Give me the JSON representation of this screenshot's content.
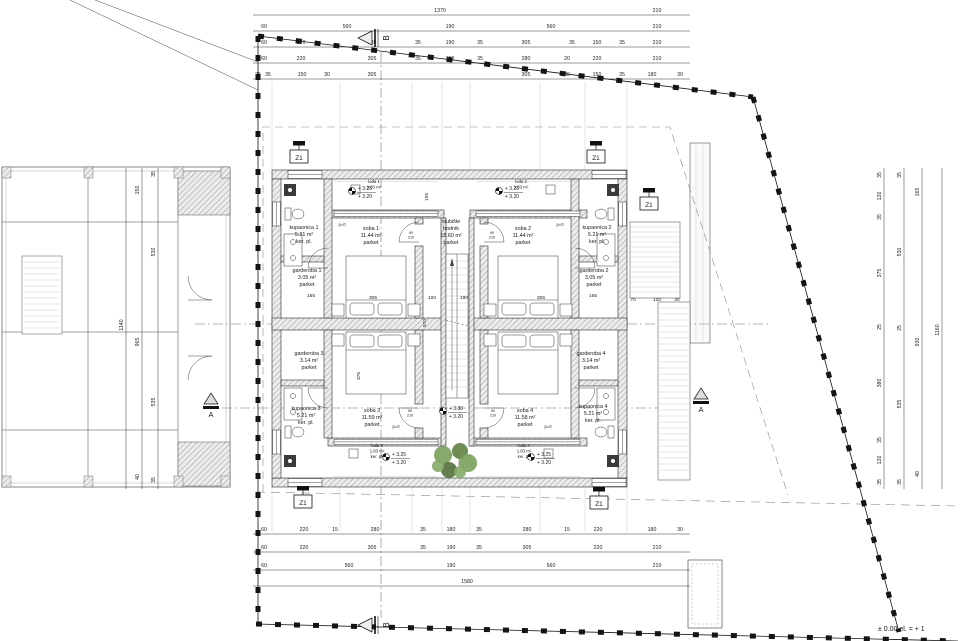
{
  "colors": {
    "plant_green": "#6b8f52",
    "plant_dark": "#53703c",
    "wall_hatch": "#ececec",
    "boundary": "#141414"
  },
  "rooms": [
    {
      "x": 304,
      "y": 229,
      "lines": [
        "kupaonica 1",
        "5.21 m²",
        "ker. pl."
      ]
    },
    {
      "x": 307,
      "y": 272,
      "lines": [
        "garderoba 1",
        "3.05 m²",
        "parket"
      ]
    },
    {
      "x": 371,
      "y": 230,
      "lines": [
        "soba 1",
        "11.44 m²",
        "parket"
      ]
    },
    {
      "x": 451,
      "y": 223,
      "lines": [
        "stubište",
        "hodnik",
        "15.60 m²",
        "parket"
      ]
    },
    {
      "x": 523,
      "y": 230,
      "lines": [
        "soba 2",
        "11.44 m²",
        "parket"
      ]
    },
    {
      "x": 597,
      "y": 229,
      "lines": [
        "kupaonica 2",
        "5.21 m²",
        "ker. pl."
      ]
    },
    {
      "x": 594,
      "y": 272,
      "lines": [
        "garderoba 2",
        "3.05 m²",
        "parket"
      ]
    },
    {
      "x": 309,
      "y": 355,
      "lines": [
        "garderoba 3",
        "3.14 m²",
        "parket"
      ]
    },
    {
      "x": 306,
      "y": 410,
      "lines": [
        "kupaonica 3",
        "5.21 m²",
        "ker. pl."
      ]
    },
    {
      "x": 372,
      "y": 412,
      "lines": [
        "soba 3",
        "11.59 m²",
        "parket"
      ]
    },
    {
      "x": 525,
      "y": 412,
      "lines": [
        "soba 4",
        "11.58 m²",
        "parket"
      ]
    },
    {
      "x": 591,
      "y": 355,
      "lines": [
        "garderoba 4",
        "3.14 m²",
        "parket"
      ]
    },
    {
      "x": 593,
      "y": 408,
      "lines": [
        "kupaonica 4",
        "5.21 m²",
        "ker. pl."
      ]
    }
  ],
  "loggias": [
    {
      "x": 374,
      "y": 183,
      "lines": [
        "lođa 1",
        "1.83 m²"
      ]
    },
    {
      "x": 521,
      "y": 183,
      "lines": [
        "lođa 2",
        "1.83 m²"
      ]
    },
    {
      "x": 377,
      "y": 447,
      "lines": [
        "lođa 3",
        "1.83 m²",
        "ker. pl."
      ]
    },
    {
      "x": 524,
      "y": 447,
      "lines": [
        "lođa 4",
        "1.83 m²",
        "ker. pl."
      ]
    }
  ],
  "elevations": [
    {
      "x": 352,
      "y": 191,
      "lines": [
        "+ 3.25",
        "+ 3.20"
      ]
    },
    {
      "x": 499,
      "y": 191,
      "lines": [
        "+ 3.25",
        "+ 3.20"
      ]
    },
    {
      "x": 443,
      "y": 411,
      "lines": [
        "+ 3.30",
        "+ 3.20"
      ]
    },
    {
      "x": 386,
      "y": 457,
      "lines": [
        "+ 3.25",
        "+ 3.20"
      ]
    },
    {
      "x": 531,
      "y": 457,
      "lines": [
        "+ 3.25",
        "+ 3.20"
      ]
    }
  ],
  "detail_markers": [
    {
      "label": "Z1",
      "x": 299,
      "y": 157
    },
    {
      "label": "Z1",
      "x": 596,
      "y": 157
    },
    {
      "label": "Z1",
      "x": 649,
      "y": 204
    },
    {
      "label": "Z1",
      "x": 303,
      "y": 502
    },
    {
      "label": "Z1",
      "x": 599,
      "y": 503
    }
  ],
  "section_markers": [
    {
      "label": "A",
      "x": 211,
      "y": 400,
      "style": "up"
    },
    {
      "label": "A",
      "x": 701,
      "y": 395,
      "style": "up"
    },
    {
      "label": "B",
      "x": 366,
      "y": 38,
      "style": "left"
    },
    {
      "label": "B",
      "x": 366,
      "y": 625,
      "style": "left"
    }
  ],
  "annotations": [
    {
      "text": "p=0",
      "x": 342,
      "y": 226
    },
    {
      "text": "p=0",
      "x": 560,
      "y": 226
    },
    {
      "text": "p=0",
      "x": 396,
      "y": 428
    },
    {
      "text": "p=0",
      "x": 548,
      "y": 428
    },
    {
      "text": "± 0.00 el. = + 1",
      "x": 878,
      "y": 631,
      "anchor": "start",
      "size": 7
    }
  ],
  "door_labels": [
    {
      "x": 411,
      "y": 234,
      "lines": [
        "90",
        "210"
      ]
    },
    {
      "x": 492,
      "y": 234,
      "lines": [
        "90",
        "210"
      ]
    },
    {
      "x": 410,
      "y": 412,
      "lines": [
        "90",
        "210"
      ]
    },
    {
      "x": 493,
      "y": 412,
      "lines": [
        "90",
        "210"
      ]
    }
  ],
  "dims": {
    "top_rows": [
      {
        "y": 12,
        "items": [
          {
            "v": "1370",
            "x": 440
          },
          {
            "v": "210",
            "x": 657
          }
        ]
      },
      {
        "y": 28,
        "items": [
          {
            "v": "60",
            "x": 264
          },
          {
            "v": "560",
            "x": 347
          },
          {
            "v": "190",
            "x": 450
          },
          {
            "v": "560",
            "x": 551
          },
          {
            "v": "210",
            "x": 657
          }
        ]
      },
      {
        "y": 44,
        "items": [
          {
            "v": "60",
            "x": 264
          },
          {
            "v": "220",
            "x": 301
          },
          {
            "v": "305",
            "x": 372
          },
          {
            "v": "35",
            "x": 418
          },
          {
            "v": "190",
            "x": 450
          },
          {
            "v": "35",
            "x": 480
          },
          {
            "v": "305",
            "x": 526
          },
          {
            "v": "35",
            "x": 572
          },
          {
            "v": "150",
            "x": 597
          },
          {
            "v": "35",
            "x": 622
          },
          {
            "v": "210",
            "x": 657
          }
        ]
      },
      {
        "y": 60,
        "items": [
          {
            "v": "60",
            "x": 264
          },
          {
            "v": "220",
            "x": 301
          },
          {
            "v": "305",
            "x": 372
          },
          {
            "v": "35",
            "x": 418
          },
          {
            "v": "180",
            "x": 450
          },
          {
            "v": "35",
            "x": 480
          },
          {
            "v": "280",
            "x": 526
          },
          {
            "v": "20",
            "x": 567
          },
          {
            "v": "220",
            "x": 597
          },
          {
            "v": "210",
            "x": 657
          }
        ]
      },
      {
        "y": 76,
        "items": [
          {
            "v": "25",
            "x": 258
          },
          {
            "v": "35",
            "x": 268
          },
          {
            "v": "150",
            "x": 302
          },
          {
            "v": "30",
            "x": 327
          },
          {
            "v": "305",
            "x": 372
          },
          {
            "v": "305",
            "x": 526
          },
          {
            "v": "30",
            "x": 567
          },
          {
            "v": "150",
            "x": 597
          },
          {
            "v": "35",
            "x": 622
          },
          {
            "v": "180",
            "x": 652
          },
          {
            "v": "30",
            "x": 680
          }
        ]
      }
    ],
    "bottom_rows": [
      {
        "y": 531,
        "items": [
          {
            "v": "60",
            "x": 264
          },
          {
            "v": "220",
            "x": 304
          },
          {
            "v": "15",
            "x": 335
          },
          {
            "v": "280",
            "x": 375
          },
          {
            "v": "35",
            "x": 423
          },
          {
            "v": "180",
            "x": 451
          },
          {
            "v": "35",
            "x": 479
          },
          {
            "v": "280",
            "x": 527
          },
          {
            "v": "15",
            "x": 567
          },
          {
            "v": "220",
            "x": 598
          },
          {
            "v": "180",
            "x": 652
          },
          {
            "v": "30",
            "x": 680
          }
        ]
      },
      {
        "y": 549,
        "items": [
          {
            "v": "60",
            "x": 264
          },
          {
            "v": "220",
            "x": 304
          },
          {
            "v": "305",
            "x": 372
          },
          {
            "v": "35",
            "x": 423
          },
          {
            "v": "190",
            "x": 451
          },
          {
            "v": "35",
            "x": 479
          },
          {
            "v": "305",
            "x": 527
          },
          {
            "v": "220",
            "x": 598
          },
          {
            "v": "210",
            "x": 657
          }
        ]
      },
      {
        "y": 567,
        "items": [
          {
            "v": "60",
            "x": 264
          },
          {
            "v": "560",
            "x": 349
          },
          {
            "v": "190",
            "x": 451
          },
          {
            "v": "560",
            "x": 551
          },
          {
            "v": "210",
            "x": 657
          }
        ]
      },
      {
        "y": 583,
        "items": [
          {
            "v": "1580",
            "x": 467
          }
        ]
      }
    ],
    "right_cols": [
      {
        "x": 881,
        "items": [
          {
            "v": "35",
            "y": 175
          },
          {
            "v": "120",
            "y": 196
          },
          {
            "v": "35",
            "y": 217
          },
          {
            "v": "375",
            "y": 273
          },
          {
            "v": "25",
            "y": 327
          },
          {
            "v": "380",
            "y": 383
          },
          {
            "v": "35",
            "y": 440
          },
          {
            "v": "120",
            "y": 460
          },
          {
            "v": "35",
            "y": 482
          }
        ]
      },
      {
        "x": 901,
        "items": [
          {
            "v": "35",
            "y": 175
          },
          {
            "v": "530",
            "y": 252
          },
          {
            "v": "25",
            "y": 328
          },
          {
            "v": "535",
            "y": 404
          },
          {
            "v": "35",
            "y": 482
          }
        ]
      },
      {
        "x": 919,
        "items": [
          {
            "v": "165",
            "y": 192
          },
          {
            "v": "930",
            "y": 342
          },
          {
            "v": "40",
            "y": 474
          }
        ]
      },
      {
        "x": 939,
        "items": [
          {
            "v": "1160",
            "y": 330
          }
        ]
      }
    ],
    "left_cols": [
      {
        "x": 123,
        "items": [
          {
            "v": "1140",
            "y": 325
          }
        ]
      },
      {
        "x": 139,
        "items": [
          {
            "v": "150",
            "y": 190
          },
          {
            "v": "965",
            "y": 342
          },
          {
            "v": "40",
            "y": 477
          }
        ]
      },
      {
        "x": 155,
        "items": [
          {
            "v": "35",
            "y": 174
          },
          {
            "v": "530",
            "y": 252
          },
          {
            "v": "535",
            "y": 402
          },
          {
            "v": "35",
            "y": 480
          }
        ]
      }
    ],
    "inner": [
      {
        "v": "305",
        "x": 373,
        "y": 299
      },
      {
        "v": "100",
        "x": 432,
        "y": 299
      },
      {
        "v": "190",
        "x": 464,
        "y": 299
      },
      {
        "v": "305",
        "x": 541,
        "y": 299
      },
      {
        "v": "165",
        "x": 311,
        "y": 297
      },
      {
        "v": "165",
        "x": 593,
        "y": 297
      },
      {
        "v": "70",
        "x": 633,
        "y": 301
      },
      {
        "v": "120",
        "x": 657,
        "y": 301
      },
      {
        "v": "30",
        "x": 677,
        "y": 301
      },
      {
        "v": "570",
        "x": 426,
        "y": 323,
        "rot": true
      },
      {
        "v": "375",
        "x": 360,
        "y": 376,
        "rot": true
      },
      {
        "v": "155",
        "x": 428,
        "y": 197,
        "rot": true
      }
    ]
  }
}
